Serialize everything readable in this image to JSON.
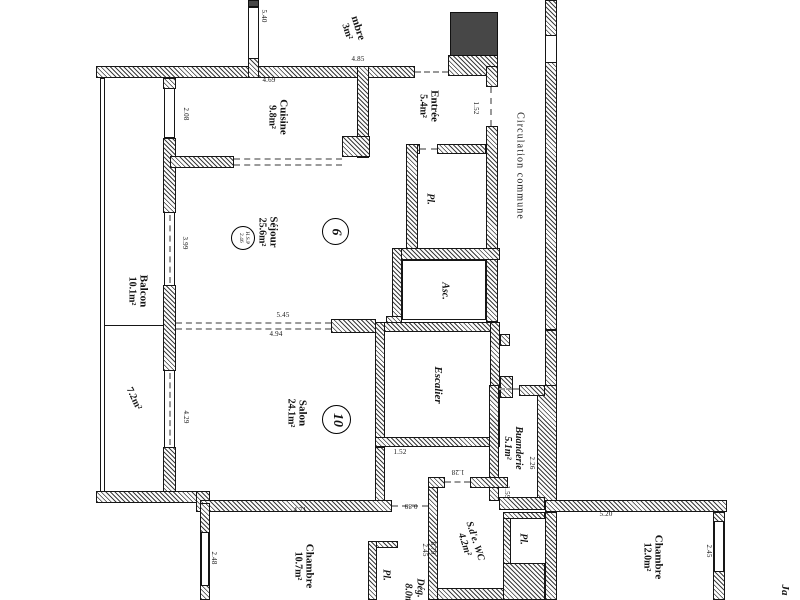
{
  "rooms": {
    "chambre_top": {
      "label": "mbre",
      "area": "3m²"
    },
    "cuisine": {
      "label": "Cuisine",
      "area": "9.8m²"
    },
    "entree": {
      "label": "Entrée",
      "area": "5.4m²"
    },
    "sejour": {
      "label": "Séjour",
      "area": "25.6m²"
    },
    "salon": {
      "label": "Salon",
      "area": "24.1m²"
    },
    "balcon": {
      "label": "Balcon",
      "area": "10.1m²"
    },
    "terrasse": {
      "area": "7.2m²"
    },
    "escalier": {
      "label": "Escalier"
    },
    "ascenseur": {
      "label": "Asc."
    },
    "placard_entree": {
      "label": "Pl."
    },
    "circulation": {
      "label": "Circulation commune"
    },
    "buanderie": {
      "label": "Buanderie",
      "area": "5.1m²"
    },
    "chambre_sw": {
      "label": "Chambre",
      "area": "10.7m²"
    },
    "placard_sw": {
      "label": "Pl."
    },
    "degagement": {
      "label": "Dég.",
      "area": "8.0m²"
    },
    "sde_wc": {
      "label": "S.d'e. WC",
      "area": "4.2m²"
    },
    "placard_se": {
      "label": "Pl."
    },
    "chambre_se": {
      "label": "Chambre",
      "area": "12.0m²"
    },
    "jardin": {
      "label": "Ja"
    }
  },
  "units": {
    "six": "6",
    "ten": "10"
  },
  "hsp": {
    "l1": "H.S.P",
    "l2": "2.46"
  },
  "dims": {
    "d540": "5.40",
    "d469": "4.69",
    "d485": "4.85",
    "d208": "2.08",
    "d152a": "1.52",
    "d399": "3.99",
    "d545": "5.45",
    "d494": "4.94",
    "d429": "4.29",
    "d152b": "1.52",
    "d226": "2.26",
    "d159": "1.59",
    "d128": "1.28",
    "d089": "0.89",
    "d245a": "2.45",
    "d879": "8.79",
    "d471": "4.71",
    "d248": "2.48",
    "d520": "5.20",
    "d245b": "2.45"
  }
}
